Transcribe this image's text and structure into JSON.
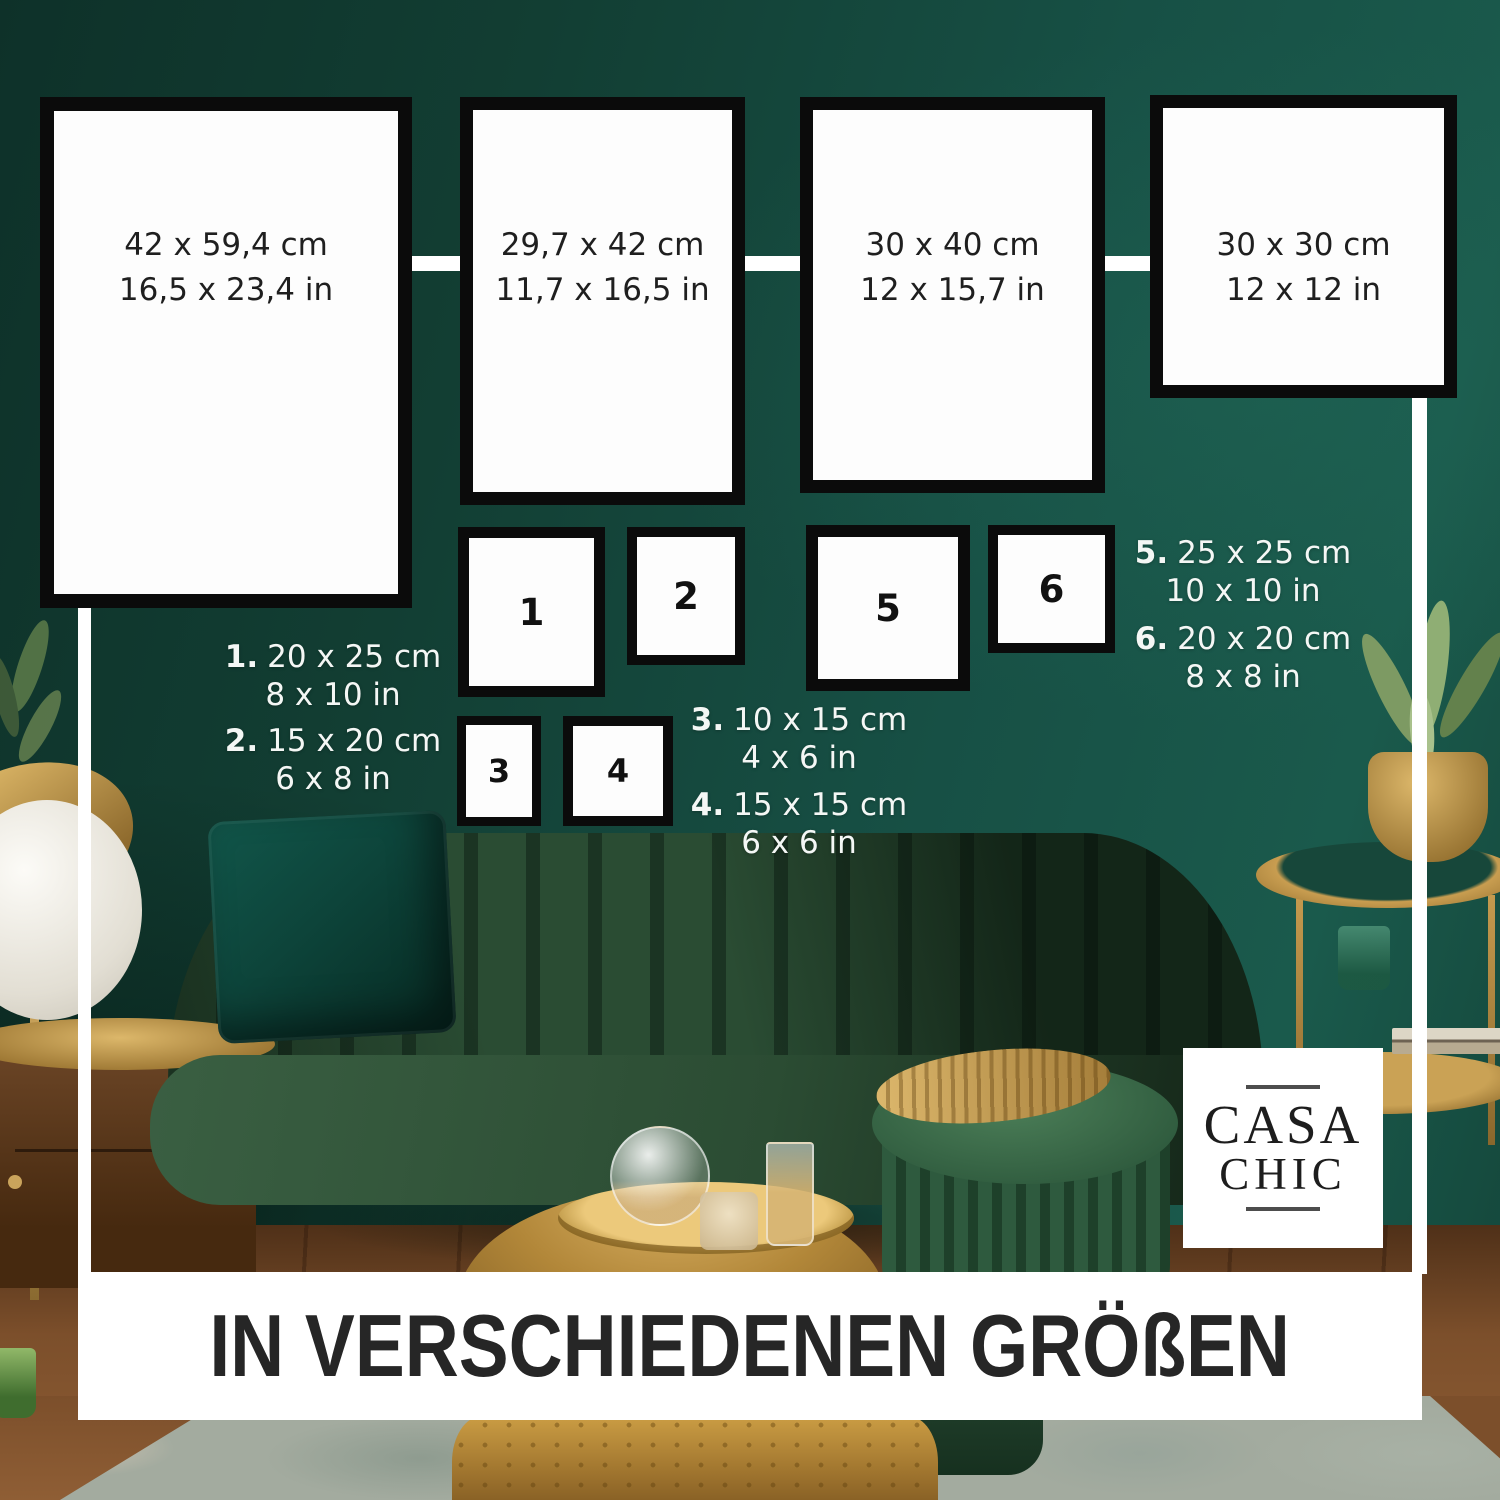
{
  "brand": {
    "name_line1": "CASA",
    "name_line2": "CHIC"
  },
  "banner": {
    "headline": "IN VERSCHIEDENEN GRÖßEN"
  },
  "large_frames": [
    {
      "size_cm": "42 x 59,4 cm",
      "size_in": "16,5 x 23,4 in"
    },
    {
      "size_cm": "29,7 x 42 cm",
      "size_in": "11,7 x 16,5 in"
    },
    {
      "size_cm": "30 x 40 cm",
      "size_in": "12 x 15,7 in"
    },
    {
      "size_cm": "30 x 30 cm",
      "size_in": "12 x 12 in"
    }
  ],
  "numbered_frames": [
    {
      "number": "1"
    },
    {
      "number": "2"
    },
    {
      "number": "3"
    },
    {
      "number": "4"
    },
    {
      "number": "5"
    },
    {
      "number": "6"
    }
  ],
  "size_legend": [
    {
      "index": "1.",
      "size_cm": "20 x 25 cm",
      "size_in": "8 x 10 in"
    },
    {
      "index": "2.",
      "size_cm": "15 x 20 cm",
      "size_in": "6 x 8 in"
    },
    {
      "index": "3.",
      "size_cm": "10 x 15 cm",
      "size_in": "4 x 6 in"
    },
    {
      "index": "4.",
      "size_cm": "15 x 15 cm",
      "size_in": "6 x 6 in"
    },
    {
      "index": "5.",
      "size_cm": "25 x 25 cm",
      "size_in": "10 x 10 in"
    },
    {
      "index": "6.",
      "size_cm": "20 x 20 cm",
      "size_in": "8 x 8 in"
    }
  ],
  "colors": {
    "wall_green": "#175045",
    "frame_border": "#0b0b0b",
    "frame_fill": "#fdfdfd",
    "legend_text": "#f4f7f5",
    "banner_text": "#262626",
    "gold_accent": "#c79e52"
  }
}
